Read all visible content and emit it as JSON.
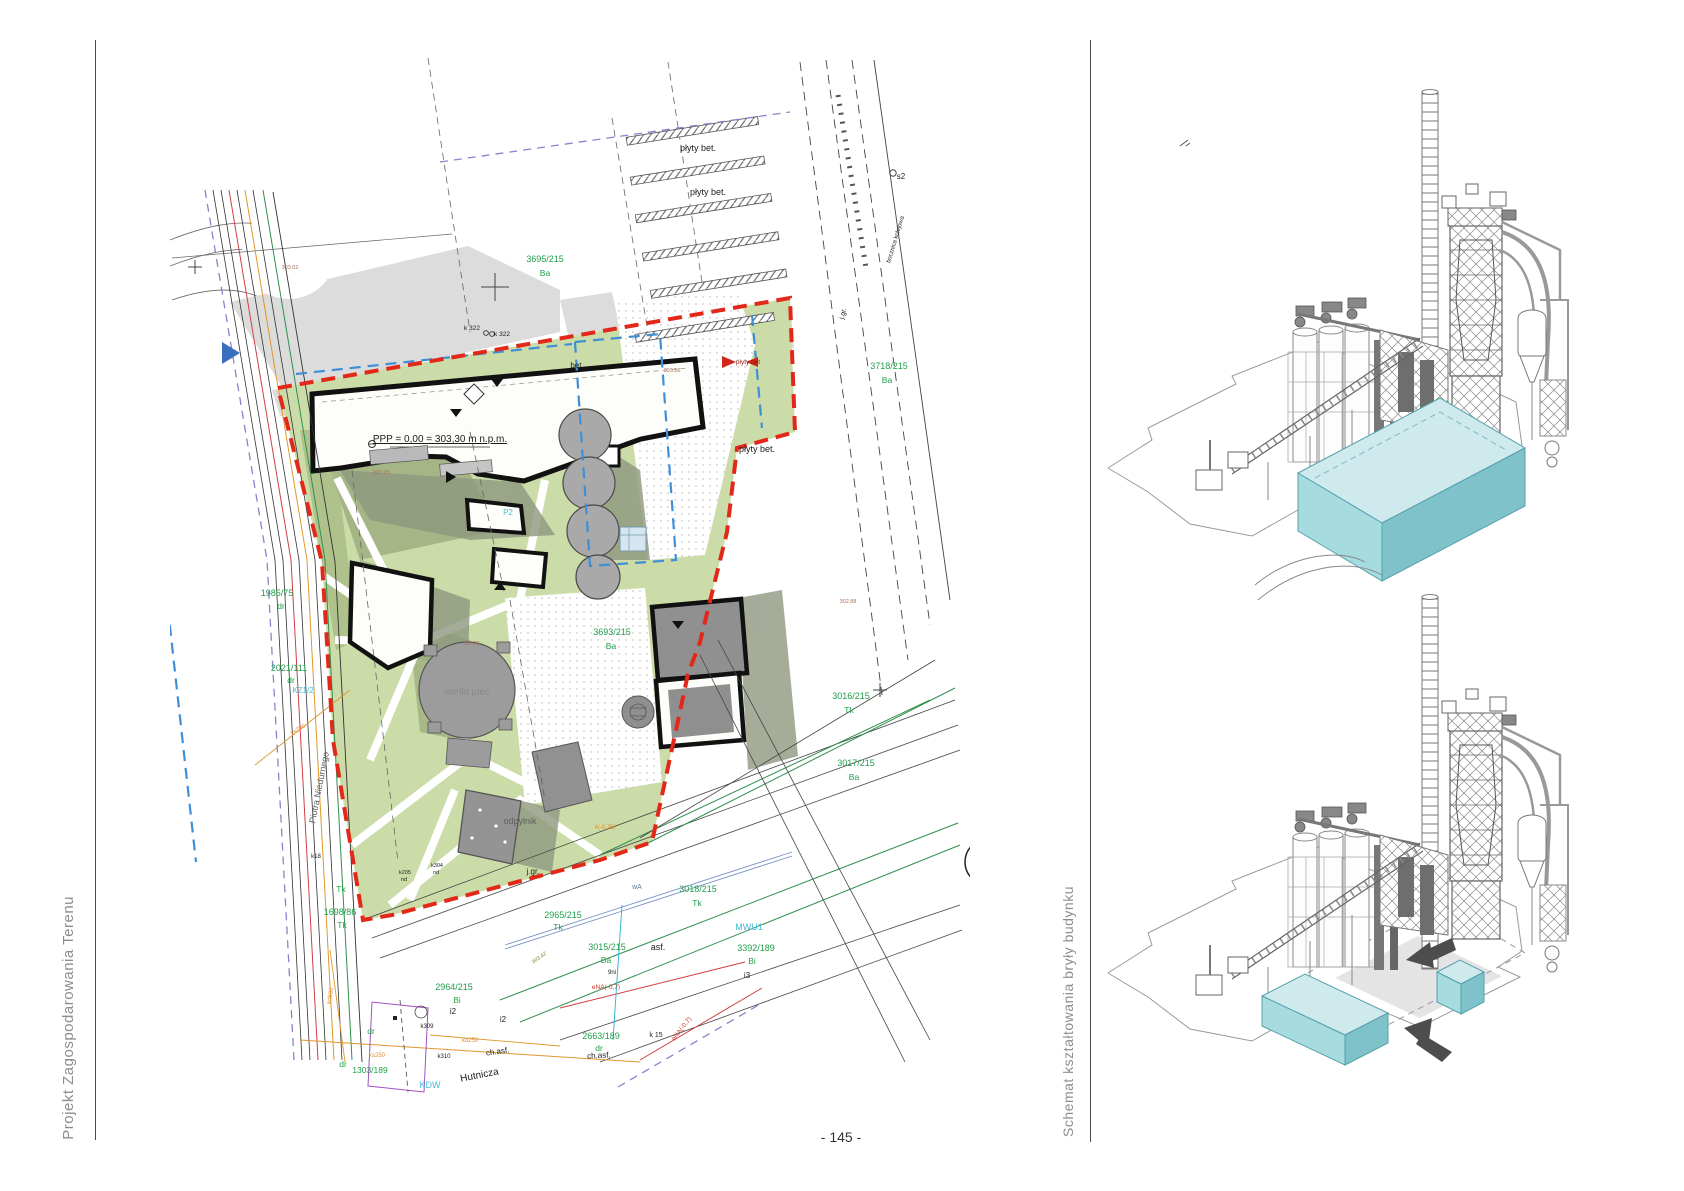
{
  "page": {
    "number": "- 145 -"
  },
  "captions": {
    "left": "Projekt Zagospodarowania Terenu",
    "right": "Schemat kształtowania bryły budynku"
  },
  "site_plan": {
    "label_colors": {
      "g": "#1f9e49",
      "c": "#45bcd6",
      "k": "#1c1c1c",
      "gy": "#8a8a8a",
      "dg": "#5e5e5e",
      "bn": "#a4705c",
      "ol": "#7c8742",
      "r": "#d23128",
      "dr": "#8f1d12",
      "o": "#dc8f2e",
      "sl": "#5c7d9e"
    },
    "labels": [
      {
        "t": "3695/215",
        "x": 545,
        "y": 262,
        "c": "g",
        "s": 9
      },
      {
        "t": "Ba",
        "x": 545,
        "y": 276,
        "c": "g",
        "s": 8.5
      },
      {
        "t": "3718/215",
        "x": 889,
        "y": 369,
        "c": "g",
        "s": 9
      },
      {
        "t": "Ba",
        "x": 887,
        "y": 383,
        "c": "g",
        "s": 8.5
      },
      {
        "t": "3693/215",
        "x": 612,
        "y": 635,
        "c": "g",
        "s": 9
      },
      {
        "t": "Ba",
        "x": 611,
        "y": 649,
        "c": "g",
        "s": 8.5
      },
      {
        "t": "3016/215",
        "x": 851,
        "y": 699,
        "c": "g",
        "s": 9
      },
      {
        "t": "Tk",
        "x": 849,
        "y": 713,
        "c": "g",
        "s": 8.5
      },
      {
        "t": "3017/215",
        "x": 856,
        "y": 766,
        "c": "g",
        "s": 9
      },
      {
        "t": "Ba",
        "x": 854,
        "y": 780,
        "c": "g",
        "s": 8.5
      },
      {
        "t": "3018/215",
        "x": 698,
        "y": 892,
        "c": "g",
        "s": 9
      },
      {
        "t": "Tk",
        "x": 697,
        "y": 906,
        "c": "g",
        "s": 8.5
      },
      {
        "t": "2965/215",
        "x": 563,
        "y": 918,
        "c": "g",
        "s": 9
      },
      {
        "t": "Tk",
        "x": 558,
        "y": 930,
        "c": "g",
        "s": 8.5
      },
      {
        "t": "3015/215",
        "x": 607,
        "y": 950,
        "c": "g",
        "s": 9
      },
      {
        "t": "Ba",
        "x": 606,
        "y": 963,
        "c": "g",
        "s": 8.5
      },
      {
        "t": "2964/215",
        "x": 454,
        "y": 990,
        "c": "g",
        "s": 9
      },
      {
        "t": "Bi",
        "x": 457,
        "y": 1003,
        "c": "g",
        "s": 8.5
      },
      {
        "t": "3392/189",
        "x": 756,
        "y": 951,
        "c": "g",
        "s": 9
      },
      {
        "t": "Bi",
        "x": 752,
        "y": 964,
        "c": "g",
        "s": 8.5
      },
      {
        "t": "1985/75",
        "x": 277,
        "y": 596,
        "c": "g",
        "s": 9
      },
      {
        "t": "dr",
        "x": 281,
        "y": 609,
        "c": "g",
        "s": 8.5
      },
      {
        "t": "2021/111",
        "x": 289,
        "y": 671,
        "c": "g",
        "s": 9
      },
      {
        "t": "dr",
        "x": 291,
        "y": 683,
        "c": "g",
        "s": 8.5
      },
      {
        "t": "1698/86",
        "x": 340,
        "y": 915,
        "c": "g",
        "s": 9
      },
      {
        "t": "Tk",
        "x": 342,
        "y": 928,
        "c": "g",
        "s": 8.5
      },
      {
        "t": "Tk",
        "x": 341,
        "y": 892,
        "c": "g",
        "s": 8.5
      },
      {
        "t": "1303/189",
        "x": 370,
        "y": 1073,
        "c": "g",
        "s": 8.5
      },
      {
        "t": "dr",
        "x": 343,
        "y": 1067,
        "c": "g",
        "s": 8.5
      },
      {
        "t": "dr",
        "x": 371,
        "y": 1034,
        "c": "g",
        "s": 8.5
      },
      {
        "t": "2663/189",
        "x": 601,
        "y": 1039,
        "c": "g",
        "s": 9
      },
      {
        "t": "dr",
        "x": 599,
        "y": 1051,
        "c": "g",
        "s": 8.5
      },
      {
        "t": "KZ1/2",
        "x": 303,
        "y": 693,
        "c": "c",
        "s": 8
      },
      {
        "t": "MWU1",
        "x": 749,
        "y": 930,
        "c": "c",
        "s": 9
      },
      {
        "t": "KDW",
        "x": 430,
        "y": 1088,
        "c": "c",
        "s": 9
      },
      {
        "t": "P2",
        "x": 508,
        "y": 515,
        "c": "c",
        "s": 8
      },
      {
        "t": "płyty bet.",
        "x": 698,
        "y": 151,
        "c": "k",
        "s": 9
      },
      {
        "t": "płyty bet.",
        "x": 708,
        "y": 195,
        "c": "k",
        "s": 9
      },
      {
        "t": "płyty bet.",
        "x": 757,
        "y": 452,
        "c": "k",
        "s": 9
      },
      {
        "t": "płyty bet",
        "x": 748,
        "y": 364,
        "c": "dr",
        "s": 6.5
      },
      {
        "t": "bet.",
        "x": 577,
        "y": 368,
        "c": "k",
        "s": 8
      },
      {
        "t": "s2",
        "x": 901,
        "y": 179,
        "c": "k",
        "s": 8
      },
      {
        "t": "k 322",
        "x": 472,
        "y": 330,
        "c": "k",
        "s": 6.5
      },
      {
        "t": "k 322",
        "x": 502,
        "y": 336,
        "c": "k",
        "s": 6.5
      },
      {
        "t": "asf.",
        "x": 658,
        "y": 950,
        "c": "k",
        "s": 9
      },
      {
        "t": "i2",
        "x": 453,
        "y": 1014,
        "c": "k",
        "s": 8
      },
      {
        "t": "i2",
        "x": 503,
        "y": 1022,
        "c": "k",
        "s": 8
      },
      {
        "t": "i3",
        "x": 747,
        "y": 978,
        "c": "k",
        "s": 8
      },
      {
        "t": "k18",
        "x": 316,
        "y": 858,
        "c": "k",
        "s": 6
      },
      {
        "t": "k205",
        "x": 405,
        "y": 874,
        "c": "k",
        "s": 5.5
      },
      {
        "t": "nd",
        "x": 404,
        "y": 881,
        "c": "k",
        "s": 5.5
      },
      {
        "t": "k304",
        "x": 437,
        "y": 867,
        "c": "k",
        "s": 5.5
      },
      {
        "t": "nd",
        "x": 436,
        "y": 874,
        "c": "k",
        "s": 5.5
      },
      {
        "t": "k309",
        "x": 427,
        "y": 1028,
        "c": "k",
        "s": 6
      },
      {
        "t": "k310",
        "x": 444,
        "y": 1058,
        "c": "k",
        "s": 6
      },
      {
        "t": "k 15",
        "x": 656,
        "y": 1037,
        "c": "k",
        "s": 7
      },
      {
        "t": "9ni",
        "x": 612,
        "y": 974,
        "c": "k",
        "s": 6
      },
      {
        "t": "ch.asf.",
        "x": 498,
        "y": 1054,
        "c": "k",
        "s": 8,
        "r": -8
      },
      {
        "t": "ch.asf.",
        "x": 599,
        "y": 1058,
        "c": "k",
        "s": 8,
        "r": -3
      },
      {
        "t": "j.gr.",
        "x": 533,
        "y": 874,
        "c": "k",
        "s": 8
      },
      {
        "t": "j.gr.",
        "x": 845,
        "y": 314,
        "c": "k",
        "s": 7,
        "r": -75
      },
      {
        "t": "Hutnicza",
        "x": 480,
        "y": 1078,
        "c": "k",
        "s": 10,
        "r": -11
      },
      {
        "t": "Piotra Niedurnego",
        "x": 322,
        "y": 788,
        "c": "dg",
        "s": 9,
        "r": -79
      },
      {
        "t": "bocznica kolejowa",
        "x": 897,
        "y": 240,
        "c": "k",
        "s": 6,
        "r": -73
      },
      {
        "t": "PPP = 0,00 = 303,30 m n.p.m.",
        "x": 440,
        "y": 442,
        "c": "k",
        "s": 10,
        "u": 1
      },
      {
        "t": "N",
        "x": 988,
        "y": 833,
        "c": "k",
        "s": 11
      },
      {
        "t": "wielki piec",
        "x": 467,
        "y": 695,
        "c": "gy",
        "s": 10
      },
      {
        "t": "odpylnik",
        "x": 520,
        "y": 824,
        "c": "dg",
        "s": 9
      },
      {
        "t": "303.56",
        "x": 672,
        "y": 372,
        "c": "bn",
        "s": 5.5
      },
      {
        "t": "303.25",
        "x": 381,
        "y": 474,
        "c": "bn",
        "s": 5.5
      },
      {
        "t": "303.39",
        "x": 471,
        "y": 645,
        "c": "bn",
        "s": 5.5
      },
      {
        "t": "303.02",
        "x": 290,
        "y": 269,
        "c": "bn",
        "s": 5.5
      },
      {
        "t": "302.88",
        "x": 848,
        "y": 603,
        "c": "bn",
        "s": 5.5
      },
      {
        "t": "303.42",
        "x": 540,
        "y": 959,
        "c": "ol",
        "s": 5.5,
        "r": -35
      },
      {
        "t": "eNA(-0,7)",
        "x": 606,
        "y": 989,
        "c": "r",
        "s": 6.5
      },
      {
        "t": "eNA(-0,7)",
        "x": 683,
        "y": 1030,
        "c": "r",
        "s": 6.5,
        "r": -52
      },
      {
        "t": "4(-0,75)",
        "x": 605,
        "y": 829,
        "c": "o",
        "s": 6
      },
      {
        "t": "ks250",
        "x": 377,
        "y": 1057,
        "c": "o",
        "s": 6
      },
      {
        "t": "kd250",
        "x": 470,
        "y": 1042,
        "c": "o",
        "s": 6
      },
      {
        "t": "ks200",
        "x": 299,
        "y": 731,
        "c": "o",
        "s": 6,
        "r": -33
      },
      {
        "t": "kd600",
        "x": 332,
        "y": 996,
        "c": "o",
        "s": 6,
        "r": -80
      },
      {
        "t": "wA",
        "x": 637,
        "y": 889,
        "c": "sl",
        "s": 7
      }
    ]
  },
  "massing": {
    "box_colors": {
      "top": "#cfeaed",
      "left": "#a6dbe0",
      "right": "#7fc2ca",
      "stroke": "#55a0aa"
    },
    "arrow_color": "#4d4d4d",
    "lineart_color": "#777777"
  }
}
